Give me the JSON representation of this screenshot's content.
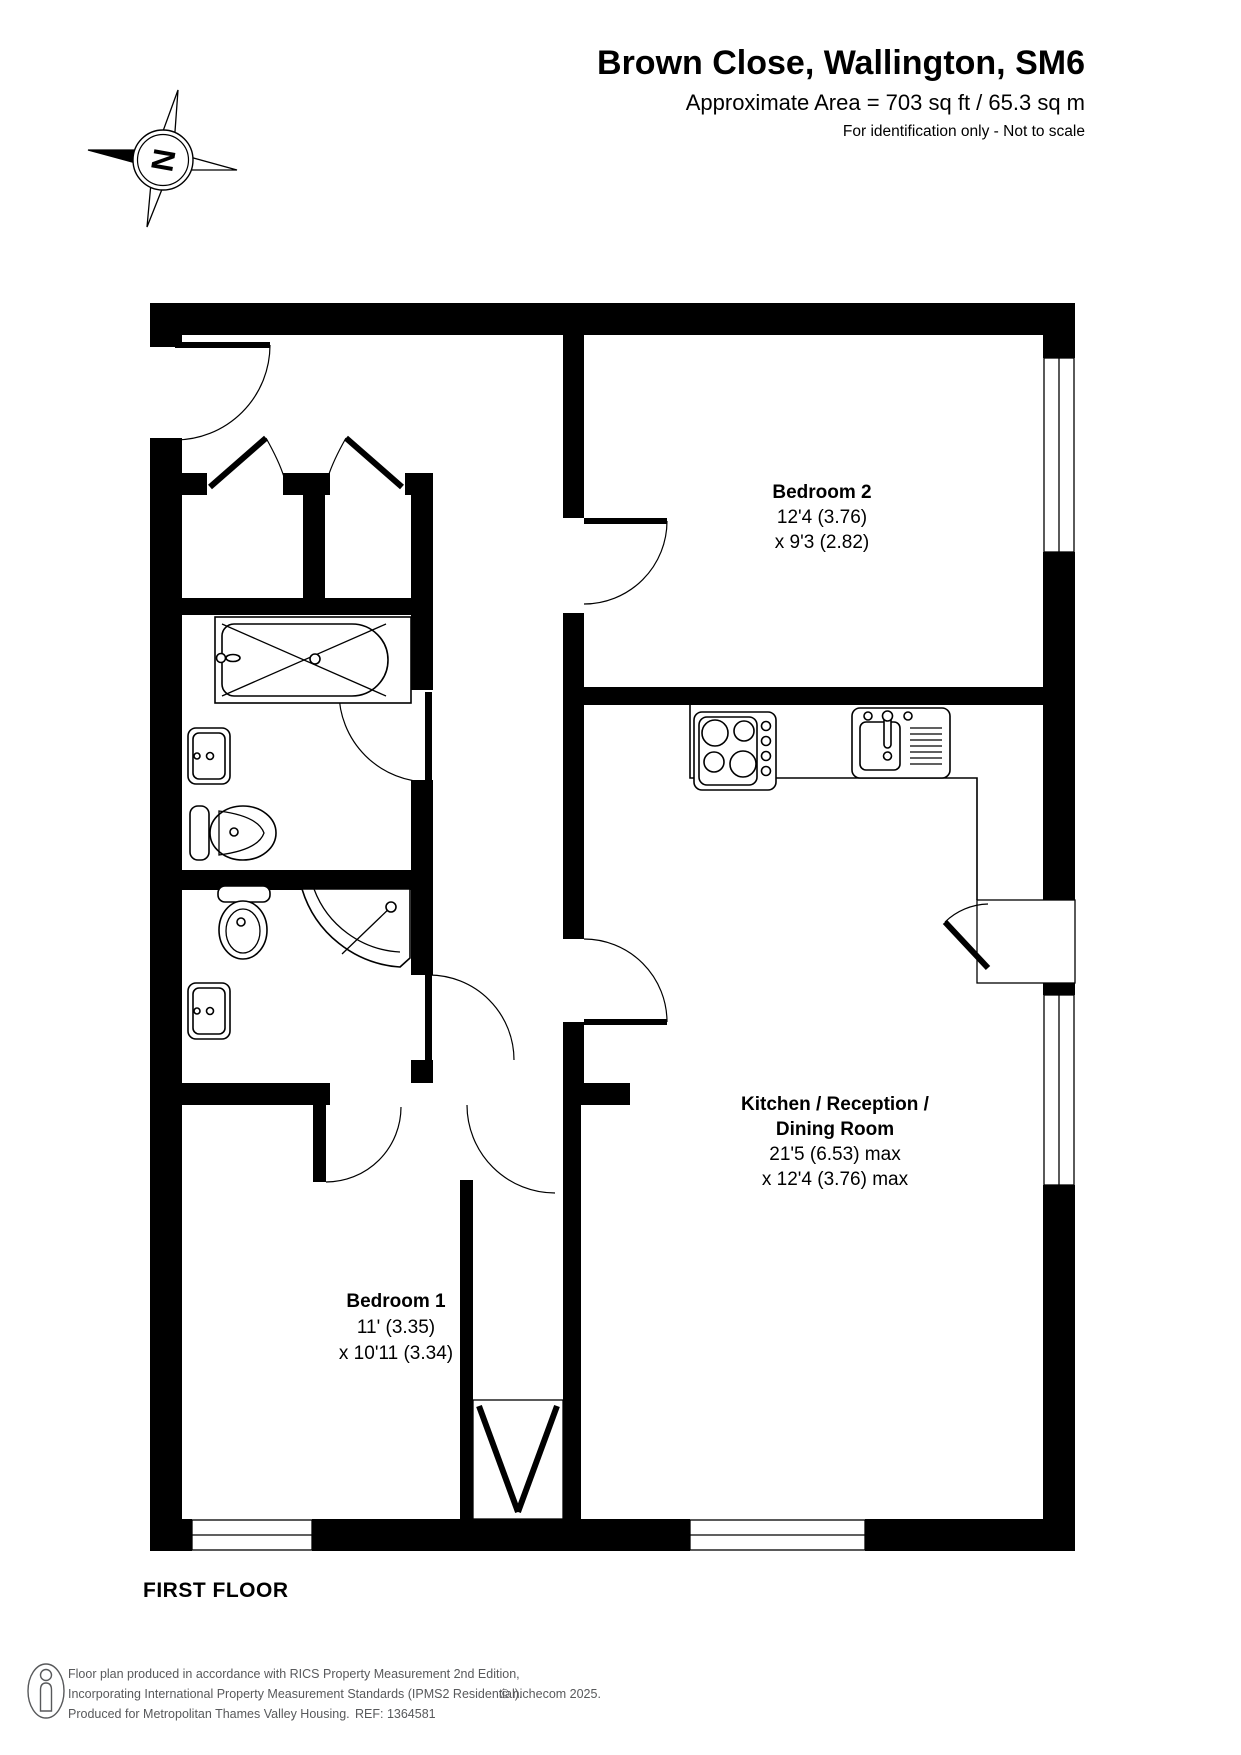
{
  "header": {
    "title": "Brown Close, Wallington, SM6",
    "area_line": "Approximate Area = 703 sq ft / 65.3 sq m",
    "note": "For identification only - Not to scale",
    "compass_letter": "N"
  },
  "rooms": {
    "bedroom2": {
      "name": "Bedroom 2",
      "dim1": "12'4 (3.76)",
      "dim2": "x 9'3 (2.82)"
    },
    "kitchen": {
      "name_line1": "Kitchen / Reception /",
      "name_line2": "Dining Room",
      "dim1": "21'5 (6.53) max",
      "dim2": "x 12'4 (3.76) max"
    },
    "bedroom1": {
      "name": "Bedroom 1",
      "dim1": "11' (3.35)",
      "dim2": "x 10'11 (3.34)"
    }
  },
  "plan": {
    "floor_label": "FIRST FLOOR"
  },
  "footer": {
    "line1": "Floor plan produced in accordance with RICS Property Measurement 2nd Edition,",
    "line2": "Incorporating International Property Measurement Standards (IPMS2 Residential).",
    "copyright": "© nichecom 2025.",
    "line3": "Produced for Metropolitan Thames Valley Housing.",
    "ref": "REF: 1364581"
  },
  "colors": {
    "wall": "#000000",
    "background": "#ffffff",
    "footer_text": "#58595b"
  }
}
